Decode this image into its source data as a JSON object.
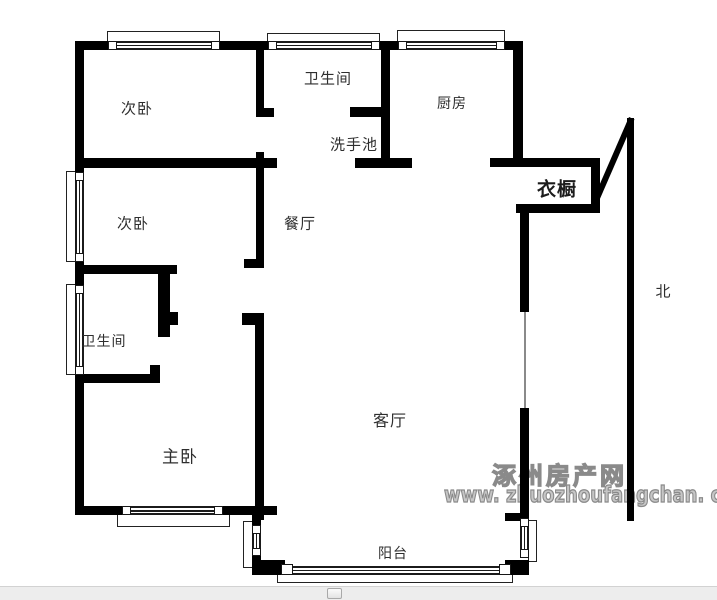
{
  "canvas": {
    "width": 717,
    "height": 600,
    "background": "#ffffff"
  },
  "floorplan": {
    "wall_color": "#000000",
    "label_color": "#2e2e2e",
    "rooms": [
      {
        "name": "bedroom-1",
        "label": "次卧",
        "x": 137,
        "y": 108,
        "size": 15
      },
      {
        "name": "bathroom-1",
        "label": "卫生间",
        "x": 328,
        "y": 78,
        "size": 15
      },
      {
        "name": "kitchen",
        "label": "厨房",
        "x": 452,
        "y": 103,
        "size": 14
      },
      {
        "name": "washbasin",
        "label": "洗手池",
        "x": 354,
        "y": 144,
        "size": 15
      },
      {
        "name": "bedroom-2",
        "label": "次卧",
        "x": 133,
        "y": 223,
        "size": 15
      },
      {
        "name": "dining-room",
        "label": "餐厅",
        "x": 300,
        "y": 223,
        "size": 15
      },
      {
        "name": "wardrobe",
        "label": "衣橱",
        "x": 557,
        "y": 188,
        "size": 19,
        "bold": true
      },
      {
        "name": "bathroom-2",
        "label": "卫生间",
        "x": 104,
        "y": 341,
        "size": 14
      },
      {
        "name": "master-bedroom",
        "label": "主卧",
        "x": 180,
        "y": 455,
        "size": 17
      },
      {
        "name": "living-room",
        "label": "客厅",
        "x": 390,
        "y": 419,
        "size": 16
      },
      {
        "name": "balcony",
        "label": "阳台",
        "x": 393,
        "y": 553,
        "size": 14
      }
    ],
    "north": {
      "label": "北",
      "x": 663,
      "y": 291,
      "line": [
        627,
        118,
        7,
        403
      ],
      "head_x": 629,
      "head_y": 117
    },
    "walls": [
      [
        75,
        41,
        33,
        9
      ],
      [
        220,
        41,
        48,
        9
      ],
      [
        380,
        41,
        18,
        9
      ],
      [
        505,
        41,
        18,
        9
      ],
      [
        75,
        41,
        9,
        131
      ],
      [
        75,
        262,
        9,
        23
      ],
      [
        75,
        375,
        9,
        140
      ],
      [
        75,
        506,
        47,
        9
      ],
      [
        223,
        506,
        54,
        9
      ],
      [
        381,
        41,
        9,
        127
      ],
      [
        513,
        41,
        10,
        122
      ],
      [
        355,
        158,
        57,
        10
      ],
      [
        350,
        107,
        31,
        10
      ],
      [
        256,
        41,
        8,
        76
      ],
      [
        256,
        108,
        18,
        9
      ],
      [
        75,
        158,
        202,
        10
      ],
      [
        256,
        152,
        8,
        116
      ],
      [
        244,
        259,
        20,
        9
      ],
      [
        242,
        313,
        22,
        12
      ],
      [
        255,
        313,
        9,
        207
      ],
      [
        75,
        265,
        102,
        9
      ],
      [
        158,
        274,
        12,
        63
      ],
      [
        170,
        312,
        8,
        13
      ],
      [
        150,
        365,
        10,
        9
      ],
      [
        75,
        374,
        85,
        9
      ],
      [
        490,
        158,
        110,
        9
      ],
      [
        591,
        158,
        9,
        55
      ],
      [
        516,
        204,
        84,
        9
      ],
      [
        520,
        210,
        9,
        102
      ],
      [
        520,
        408,
        9,
        115
      ],
      [
        505,
        513,
        15,
        8
      ],
      [
        252,
        515,
        9,
        13
      ],
      [
        252,
        556,
        9,
        10
      ],
      [
        252,
        560,
        33,
        15
      ],
      [
        505,
        560,
        24,
        15
      ]
    ],
    "window_frames": [
      [
        107,
        31,
        113,
        11
      ],
      [
        267,
        33,
        113,
        9
      ],
      [
        397,
        30,
        108,
        12
      ],
      [
        66,
        171,
        10,
        91
      ],
      [
        66,
        284,
        10,
        91
      ],
      [
        117,
        514,
        113,
        13
      ],
      [
        277,
        574,
        236,
        9
      ],
      [
        528,
        520,
        9,
        42
      ],
      [
        243,
        521,
        10,
        47
      ]
    ],
    "glass_lines": [
      [
        117,
        41,
        94,
        2
      ],
      [
        117,
        44.5,
        94,
        1.5
      ],
      [
        117,
        48,
        94,
        2
      ],
      [
        277,
        41,
        94,
        2
      ],
      [
        277,
        44.5,
        94,
        1.5
      ],
      [
        277,
        48,
        94,
        2
      ],
      [
        407,
        41,
        89,
        2
      ],
      [
        407,
        44.5,
        89,
        1.5
      ],
      [
        407,
        48,
        89,
        2
      ],
      [
        75,
        181,
        2,
        72
      ],
      [
        78.5,
        181,
        1.5,
        72
      ],
      [
        82,
        181,
        2,
        72
      ],
      [
        75,
        294,
        2,
        72
      ],
      [
        78.5,
        294,
        1.5,
        72
      ],
      [
        82,
        294,
        2,
        72
      ],
      [
        131,
        506,
        83,
        2
      ],
      [
        131,
        510,
        83,
        1.5
      ],
      [
        131,
        513,
        83,
        2
      ],
      [
        285,
        566,
        220,
        2
      ],
      [
        285,
        569.5,
        220,
        1.5
      ],
      [
        285,
        573,
        220,
        2
      ],
      [
        252,
        534,
        2,
        14
      ],
      [
        255.5,
        534,
        1.5,
        14
      ],
      [
        259,
        534,
        2,
        14
      ],
      [
        520,
        527,
        2,
        22
      ],
      [
        523.5,
        527,
        1.5,
        22
      ],
      [
        527,
        527,
        2,
        22
      ]
    ],
    "door_lines": [
      [
        524,
        312,
        1.5,
        96
      ]
    ],
    "window_markers": [
      [
        108,
        41,
        9,
        9
      ],
      [
        211,
        41,
        9,
        9
      ],
      [
        268,
        41,
        9,
        9
      ],
      [
        371,
        41,
        9,
        9
      ],
      [
        398,
        41,
        9,
        9
      ],
      [
        496,
        41,
        9,
        9
      ],
      [
        75,
        172,
        9,
        9
      ],
      [
        75,
        253,
        9,
        9
      ],
      [
        75,
        285,
        9,
        9
      ],
      [
        75,
        366,
        9,
        9
      ],
      [
        122,
        506,
        9,
        9
      ],
      [
        214,
        506,
        9,
        9
      ],
      [
        252,
        525,
        9,
        9
      ],
      [
        252,
        548,
        9,
        8
      ],
      [
        281,
        564,
        12,
        11
      ],
      [
        499,
        564,
        12,
        11
      ],
      [
        520,
        518,
        9,
        9
      ],
      [
        520,
        549,
        9,
        9
      ]
    ]
  },
  "watermark": {
    "line1": "涿州房产网",
    "line2": "www. zhuozhoufangchan. com",
    "color": "#8a8a8a"
  },
  "bottom_bar": {
    "background": "#ededed",
    "handle": {
      "x": 327,
      "y": 588,
      "w": 15,
      "h": 11
    }
  }
}
